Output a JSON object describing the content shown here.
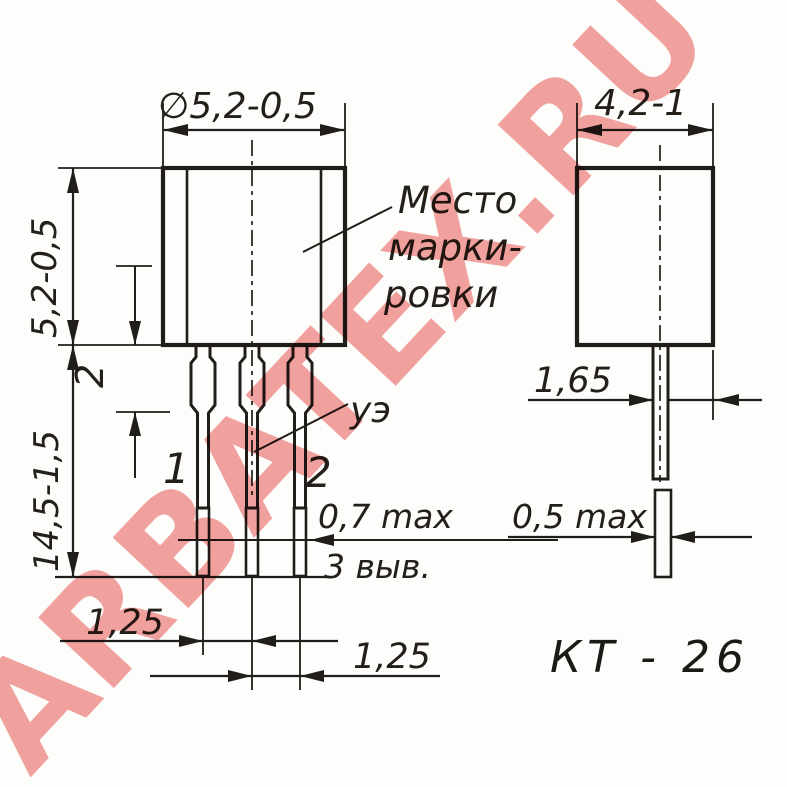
{
  "watermark": {
    "text": "ARBATEX.RU",
    "color": "#ef8e8b"
  },
  "package_name": "КТ - 26",
  "front_view": {
    "dim_width": "∅5,2-0,5",
    "dim_body_height": "5,2-0,5",
    "dim_total_height": "14,5-1,5",
    "dim_shoulder_length": "2",
    "dim_lead_thickness": "0,7 max",
    "lead_count_note": "3 выв.",
    "dim_pitch_left": "1,25",
    "dim_pitch_right": "1,25",
    "lead1_label": "1",
    "lead2_label": "2",
    "electrode_label": "уэ",
    "marking_note_line1": "Место",
    "marking_note_line2": "марки-",
    "marking_note_line3": "ровки"
  },
  "side_view": {
    "dim_depth": "4,2-1",
    "dim_lead_offset": "1,65",
    "dim_lead_width": "0,5 max"
  }
}
